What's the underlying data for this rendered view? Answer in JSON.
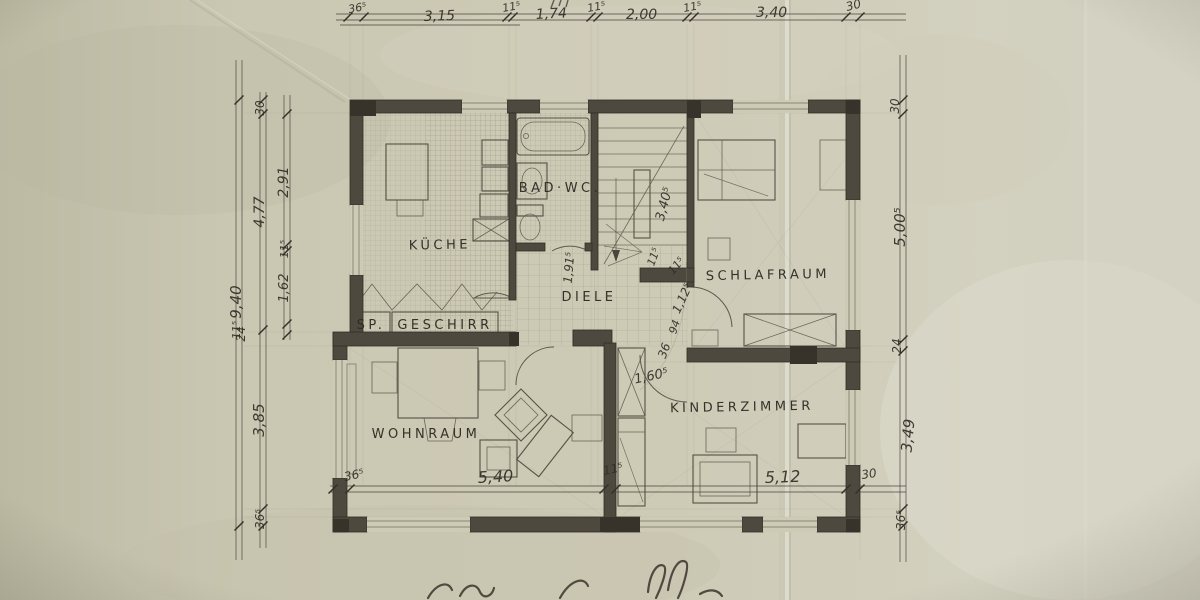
{
  "sheet": {
    "type": "hand-drawn pencil floor plan, ground floor of a house, photographed on aged folded paper"
  },
  "colors": {
    "paper": "#c9c6b0",
    "paper_light": "#d8d6c6",
    "paper_shadow": "#b3b09a",
    "pencil_ink": "#322e27",
    "wall_fill": "#4e493e"
  },
  "rooms": {
    "kueche": {
      "label": "KÜCHE"
    },
    "bad_wc": {
      "label": "BAD·WC."
    },
    "diele": {
      "label": "DIELE"
    },
    "schlafraum": {
      "label": "SCHLAFRAUM"
    },
    "wohnraum": {
      "label": "WOHNRAUM"
    },
    "kinderzimmer": {
      "label": "KINDERZIMMER"
    },
    "sp": {
      "label": "SP."
    },
    "geschirr": {
      "label": "GESCHIRR"
    }
  },
  "dims": {
    "top": [
      "36⁵",
      "3,15",
      "11⁵",
      "1,74",
      "11⁵",
      "2,00",
      "11⁵",
      "3,40",
      "30"
    ],
    "bottom": [
      "36⁵",
      "5,40",
      "11⁵",
      "5,12",
      "30"
    ],
    "left_outer": [
      "9,40",
      "11⁵"
    ],
    "left_mid": [
      "30",
      "4,77",
      "3,85",
      "36⁵"
    ],
    "left_inner": [
      "2,91",
      "11⁵",
      "1,62",
      "24"
    ],
    "right": [
      "30",
      "5,00⁵",
      "24",
      "3,49",
      "36⁵"
    ],
    "stair": [
      "3,40⁵",
      "11⁵"
    ],
    "diele_chain": [
      "1,91⁵",
      "11⁵",
      "1,12⁵",
      "94",
      "36",
      "1,60⁵"
    ]
  }
}
